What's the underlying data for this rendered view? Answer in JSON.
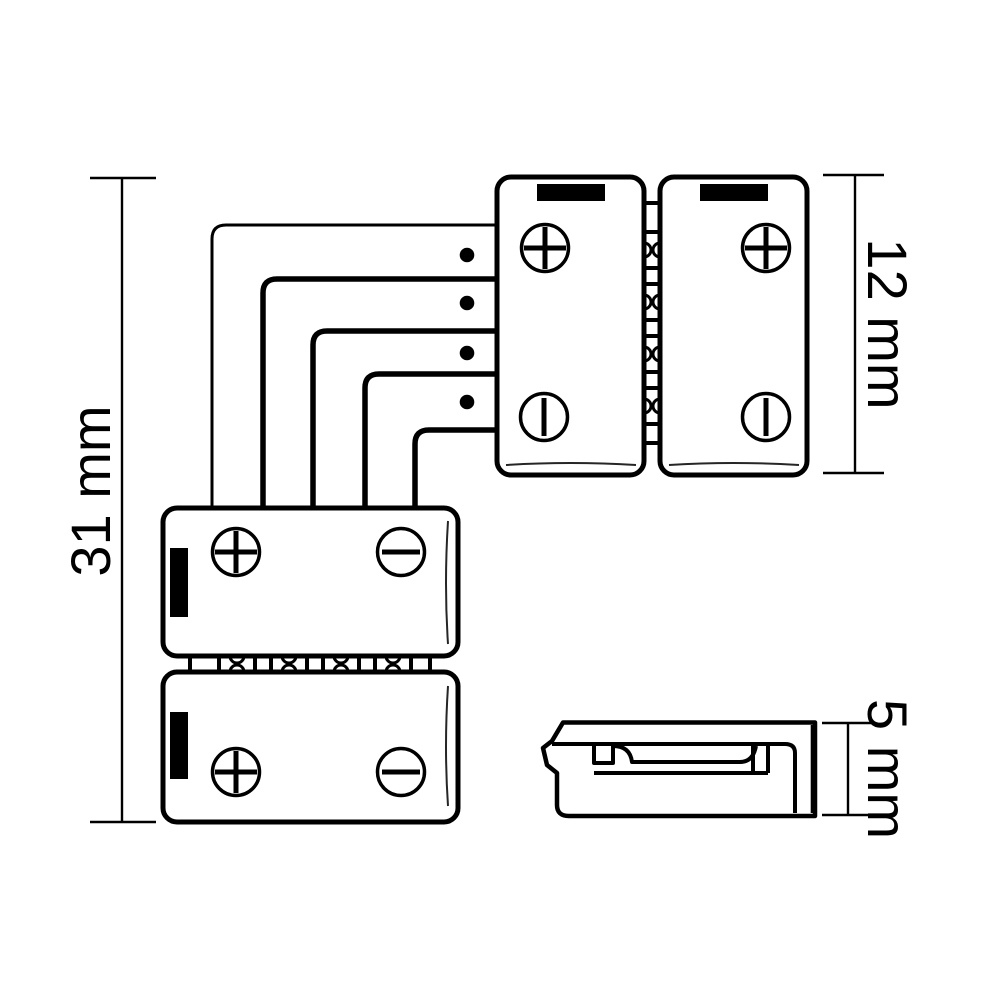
{
  "diagram": {
    "kind": "LED strip corner connector technical drawing",
    "dimensions": {
      "overall_length": {
        "label": "31 mm"
      },
      "connector_width": {
        "label": "12 mm"
      },
      "connector_height": {
        "label": "5 mm"
      }
    },
    "symbols": {
      "positive": "+",
      "negative": "−"
    },
    "colors": {
      "line": "#000000",
      "background": "#ffffff",
      "pad_fill": "#000000"
    }
  }
}
